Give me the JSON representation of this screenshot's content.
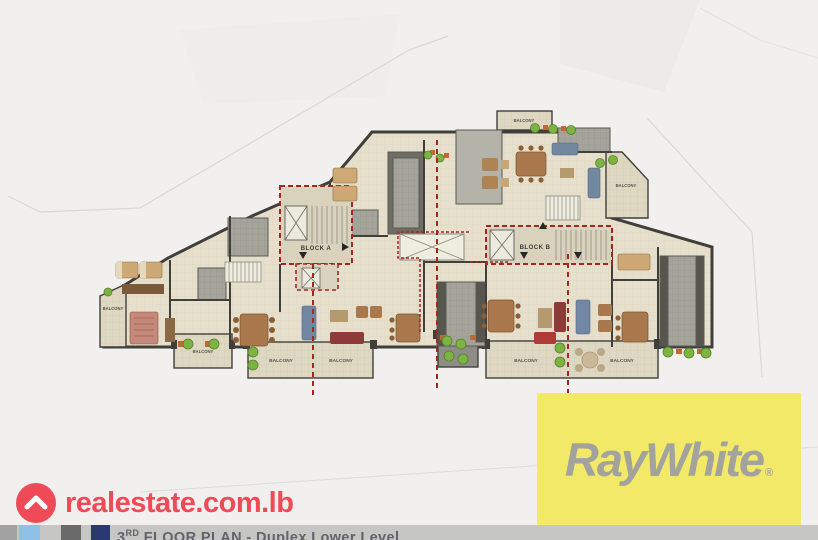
{
  "plan": {
    "block_a_label": "BLOCK A",
    "block_b_label": "BLOCK B",
    "balconies": [
      {
        "id": "left-side",
        "label": "BALCONY"
      },
      {
        "id": "bottom-left-small",
        "label": "BALCONY"
      },
      {
        "id": "bottom-left-a",
        "label": "BALCONY"
      },
      {
        "id": "bottom-left-b",
        "label": "BALCONY"
      },
      {
        "id": "top-center",
        "label": "BALCONY"
      },
      {
        "id": "top-right",
        "label": "BALCONY"
      },
      {
        "id": "bottom-right-a",
        "label": "BALCONY"
      },
      {
        "id": "bottom-right-b",
        "label": "BALCONY"
      }
    ],
    "section_line_color": "#a32622",
    "wall_color": "#403f3a",
    "floor_color": "#e6dfcb"
  },
  "branding": {
    "realestate": {
      "text": "realestate.com.lb",
      "color": "#ee4a57"
    },
    "raywhite": {
      "name": "RayWhite",
      "registered_mark": "®",
      "background": "#f3e969",
      "text_color": "#a3a39e"
    }
  },
  "caption": {
    "floor_number": "3",
    "floor_ordinal": "RD",
    "title": " FLOOR PLAN - Duplex Lower Level",
    "palette_squares": [
      "#a3a3a3",
      "#8fc0e8",
      "#6a6a6a",
      "#2b3a6e"
    ],
    "bar_color": "#c6c6c4"
  }
}
